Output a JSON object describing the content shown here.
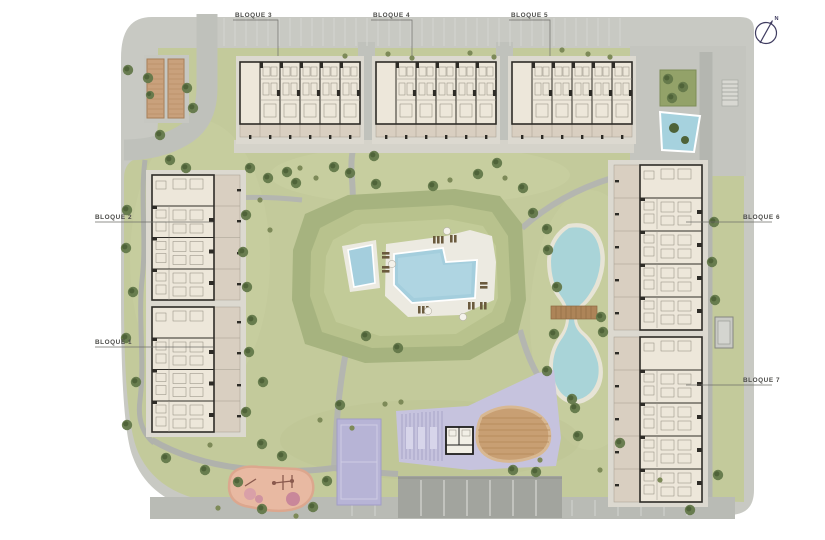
{
  "labels": {
    "blocks": [
      {
        "id": "bloque-3",
        "text": "BLOQUE 3"
      },
      {
        "id": "bloque-4",
        "text": "BLOQUE 4"
      },
      {
        "id": "bloque-5",
        "text": "BLOQUE 5"
      },
      {
        "id": "bloque-2",
        "text": "BLOQUE 2"
      },
      {
        "id": "bloque-1",
        "text": "BLOQUE 1"
      },
      {
        "id": "bloque-6",
        "text": "BLOQUE 6"
      },
      {
        "id": "bloque-7",
        "text": "BLOQUE 7"
      }
    ]
  },
  "north": {
    "label": "N"
  },
  "colors": {
    "page": "#ffffff",
    "site_base": "#c8c9c3",
    "lawn": "#c3ca9b",
    "mound_ring": "#a6b37f",
    "mound_inner": "#b8c28d",
    "path": "#b4b6b0",
    "walkway": "#d5d3ca",
    "building_floor": "#ede7da",
    "building_wall": "#2e2c27",
    "terrace": "#d9cfc1",
    "pool_water": "#a4cedd",
    "pond_water": "#a9d4d8",
    "pool_deck": "#eceae1",
    "court_purple": "#b7b4d6",
    "garage_roof": "#c6c3de",
    "sand_mound": "#c99e6e",
    "playground": "#e8b9a2",
    "pergola": "#c9a17c",
    "tree": "#5f7546",
    "parking": "#a2a49e",
    "bridge": "#ad8458",
    "north_arrow": "#3f3c60"
  }
}
